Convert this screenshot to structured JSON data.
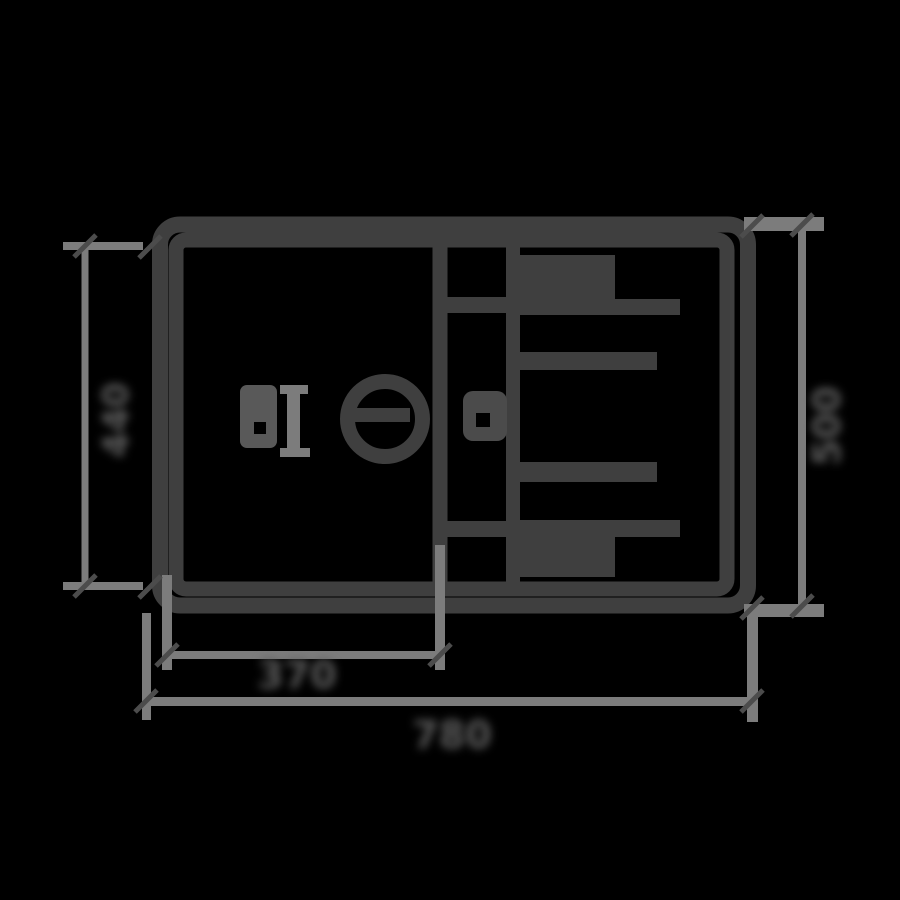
{
  "page": {
    "background": "#000000"
  },
  "diagram": {
    "kind": "sink-top-view-dimensional-drawing",
    "colors": {
      "background": "#000000",
      "outline": "#3F3F3F",
      "dimension_lines": "#7C7C7C",
      "dimension_arrows": "#4C4C4C",
      "labels": "#5C5C5C",
      "drain_fitting": "#4B4B4B",
      "faucet_mark": "#7C7C7C",
      "waste_mark": "#595959"
    },
    "dimensions": {
      "bowl_depth": {
        "label": "440",
        "side": "left"
      },
      "overall_depth": {
        "label": "500",
        "side": "right"
      },
      "bowl_width": {
        "label": "370",
        "side": "bottom-inner"
      },
      "overall_width": {
        "label": "780",
        "side": "bottom-outer"
      }
    }
  }
}
